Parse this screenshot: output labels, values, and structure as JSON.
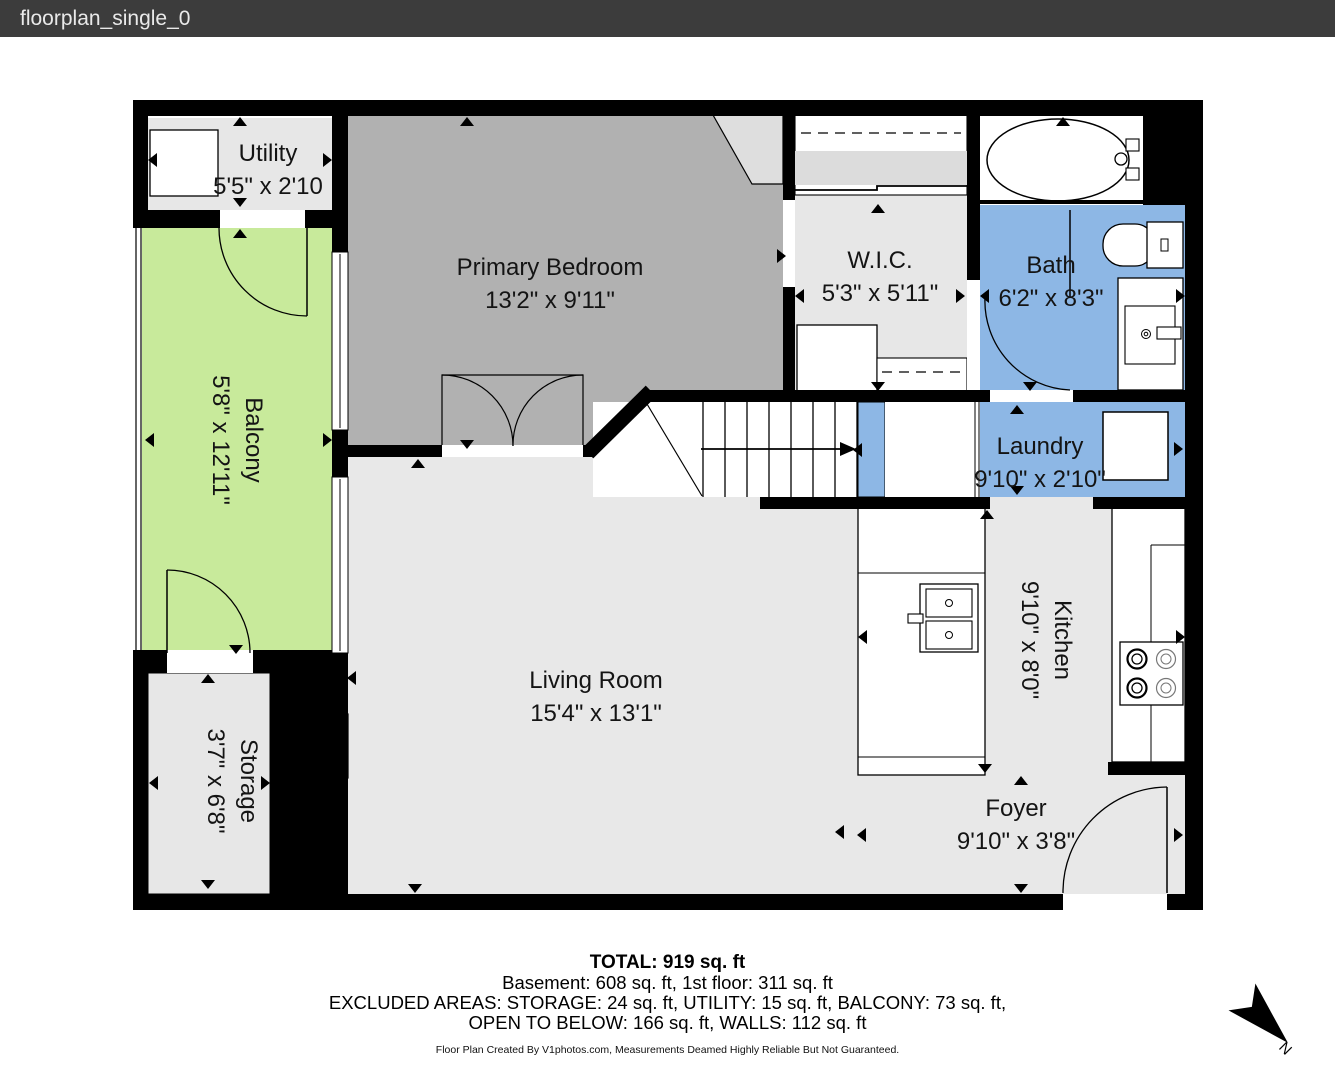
{
  "window": {
    "title": "floorplan_single_0"
  },
  "rooms": {
    "utility": {
      "name": "Utility",
      "dims": "5'5\" x 2'10"
    },
    "primary_bedroom": {
      "name": "Primary Bedroom",
      "dims": "13'2\" x 9'11\""
    },
    "wic": {
      "name": "W.I.C.",
      "dims": "5'3\" x 5'11\""
    },
    "bath": {
      "name": "Bath",
      "dims": "6'2\" x 8'3\""
    },
    "balcony": {
      "name": "Balcony",
      "dims": "5'8\" x 12'11\""
    },
    "laundry": {
      "name": "Laundry",
      "dims": "9'10\" x 2'10\""
    },
    "living_room": {
      "name": "Living Room",
      "dims": "15'4\" x 13'1\""
    },
    "kitchen": {
      "name": "Kitchen",
      "dims": "9'10\" x 8'0\""
    },
    "storage": {
      "name": "Storage",
      "dims": "3'7\" x 6'8\""
    },
    "foyer": {
      "name": "Foyer",
      "dims": "9'10\" x 3'8\""
    }
  },
  "summary": {
    "total": "TOTAL: 919 sq. ft",
    "line2": "Basement: 608 sq. ft, 1st floor: 311 sq. ft",
    "line3": "EXCLUDED AREAS: STORAGE: 24 sq. ft, UTILITY: 15 sq. ft, BALCONY: 73 sq. ft,",
    "line4": "OPEN TO BELOW: 166 sq. ft, WALLS: 112 sq. ft",
    "credit": "Floor Plan Created By V1photos.com, Measurements Deamed Highly Reliable But Not Guaranteed."
  },
  "compass": {
    "label": "N"
  },
  "colors": {
    "titlebar": "#3c3c3c",
    "wall": "#000000",
    "bedroom_floor": "#b1b1b1",
    "floor": "#e8e8e8",
    "wet_room": "#8db7e5",
    "balcony": "#c8ea9b"
  }
}
